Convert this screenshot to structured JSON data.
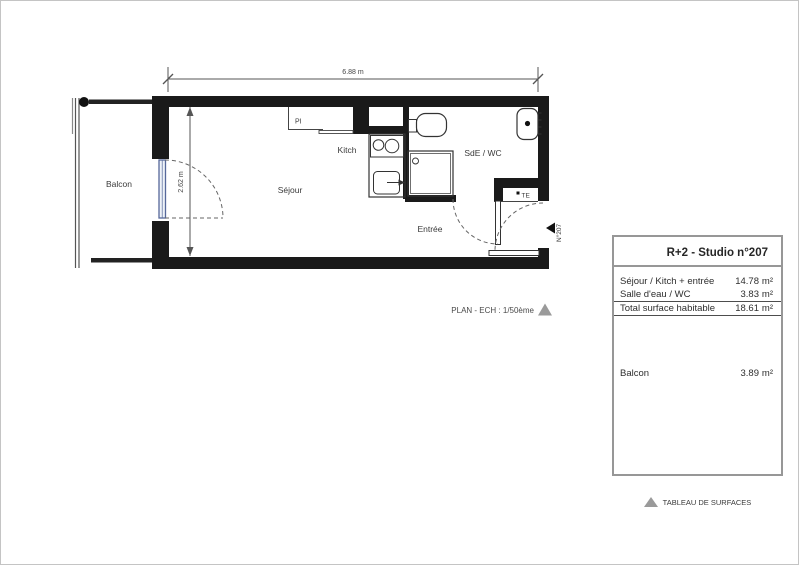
{
  "plan": {
    "rooms": {
      "balcon": "Balcon",
      "sejour": "Séjour",
      "kitch": "Kitch",
      "sde_wc": "SdE / WC",
      "entree": "Entrée"
    },
    "annotations": {
      "pi": "PI",
      "te": "TE",
      "unit_number": "N°207"
    },
    "dimensions": {
      "width": "6.88 m",
      "height": "2.62 m"
    },
    "scale_caption": "PLAN - ECH : 1/50ème"
  },
  "surface_table": {
    "title": "R+2 - Studio n°207",
    "rows": [
      {
        "label": "Séjour / Kitch + entrée",
        "value": "14.78",
        "unit": "m²"
      },
      {
        "label": "Salle d'eau / WC",
        "value": "3.83",
        "unit": "m²"
      },
      {
        "label": "Total surface habitable",
        "value": "18.61",
        "unit": "m²"
      }
    ],
    "balcony_row": {
      "label": "Balcon",
      "value": "3.89",
      "unit": "m²"
    },
    "caption": "TABLEAU DE SURFACES"
  },
  "colors": {
    "wall": "#1a1a1a",
    "line": "#444444",
    "window": "#56689a",
    "gray_triangle": "#9a9a9a"
  }
}
